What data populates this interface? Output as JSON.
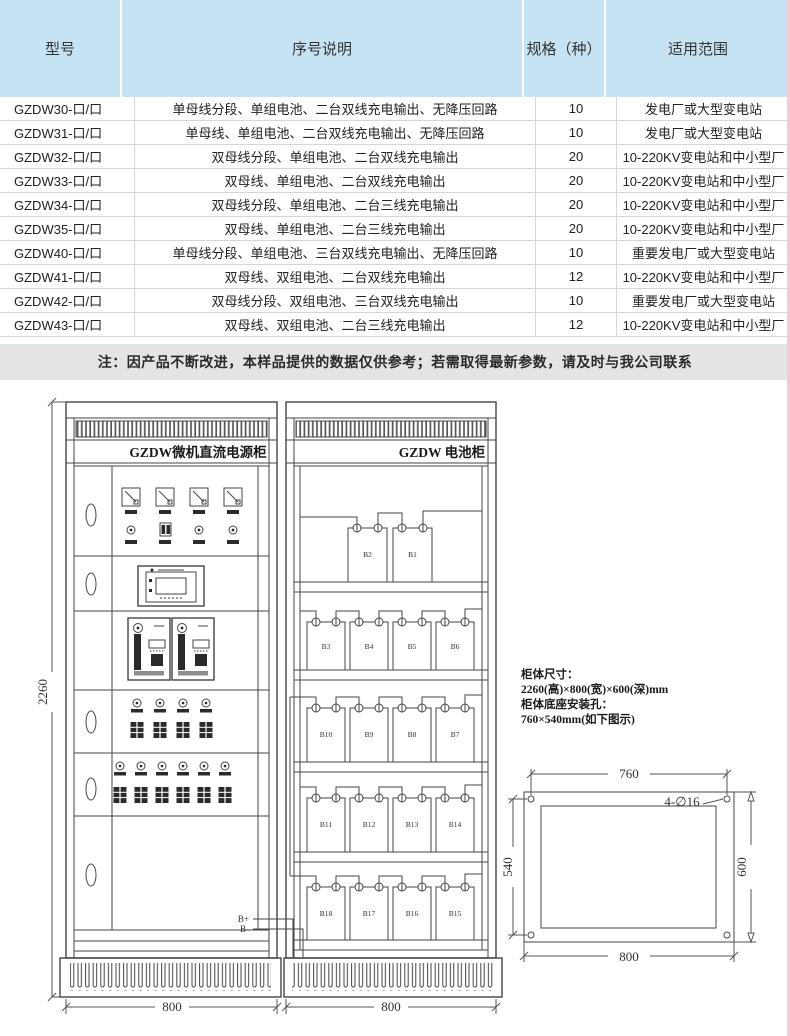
{
  "page": {
    "note": "注：因产品不断改进，本样品提供的数据仅供参考；若需取得最新参数，请及时与我公司联系"
  },
  "table": {
    "headers": [
      "型号",
      "序号说明",
      "规格（种）",
      "适用范围"
    ],
    "rows": [
      {
        "model": "GZDW30-口/口",
        "desc": "单母线分段、单组电池、二台双线充电输出、无降压回路",
        "spec": "10",
        "range": "发电厂或大型变电站"
      },
      {
        "model": "GZDW31-口/口",
        "desc": "单母线、单组电池、二台双线充电输出、无降压回路",
        "spec": "10",
        "range": "发电厂或大型变电站"
      },
      {
        "model": "GZDW32-口/口",
        "desc": "双母线分段、单组电池、二台双线充电输出",
        "spec": "20",
        "range": "10-220KV变电站和中小型厂"
      },
      {
        "model": "GZDW33-口/口",
        "desc": "双母线、单组电池、二台双线充电输出",
        "spec": "20",
        "range": "10-220KV变电站和中小型厂"
      },
      {
        "model": "GZDW34-口/口",
        "desc": "双母线分段、单组电池、二台三线充电输出",
        "spec": "20",
        "range": "10-220KV变电站和中小型厂"
      },
      {
        "model": "GZDW35-口/口",
        "desc": "双母线、单组电池、二台三线充电输出",
        "spec": "20",
        "range": "10-220KV变电站和中小型厂"
      },
      {
        "model": "GZDW40-口/口",
        "desc": "单母线分段、单组电池、三台双线充电输出、无降压回路",
        "spec": "10",
        "range": "重要发电厂或大型变电站"
      },
      {
        "model": "GZDW41-口/口",
        "desc": "双母线、双组电池、二台双线充电输出",
        "spec": "12",
        "range": "10-220KV变电站和中小型厂"
      },
      {
        "model": "GZDW42-口/口",
        "desc": "双母线分段、双组电池、三台双线充电输出",
        "spec": "10",
        "range": "重要发电厂或大型变电站"
      },
      {
        "model": "GZDW43-口/口",
        "desc": "双母线、双组电池、二台三线充电输出",
        "spec": "12",
        "range": "10-220KV变电站和中小型厂"
      }
    ]
  },
  "drawing": {
    "power_cabinet_title": "GZDW微机直流电源柜",
    "battery_cabinet_title": "GZDW 电池柜",
    "height_dim": "2260",
    "power_width_dim": "800",
    "battery_width_dim": "800",
    "bplus": "B+",
    "bminus": "B-",
    "batteries": [
      "B2",
      "B1",
      "B3",
      "B4",
      "B5",
      "B6",
      "B10",
      "B9",
      "B8",
      "B7",
      "B11",
      "B12",
      "B13",
      "B14",
      "B18",
      "B17",
      "B16",
      "B15"
    ],
    "specs_line1": "柜体尺寸：",
    "specs_line2": "2260(高)×800(宽)×600(深)mm",
    "specs_line3": "柜体底座安装孔：",
    "specs_line4": "760×540mm(如下图示)",
    "mounting": {
      "top": "760",
      "left": "540",
      "right": "600",
      "bottom": "800",
      "holes": "4-∅16"
    }
  },
  "colors": {
    "header_bg": "#c6e3f4",
    "note_bg": "#e4e4e4",
    "line": "#454545",
    "edge": "#f0cdd3"
  }
}
